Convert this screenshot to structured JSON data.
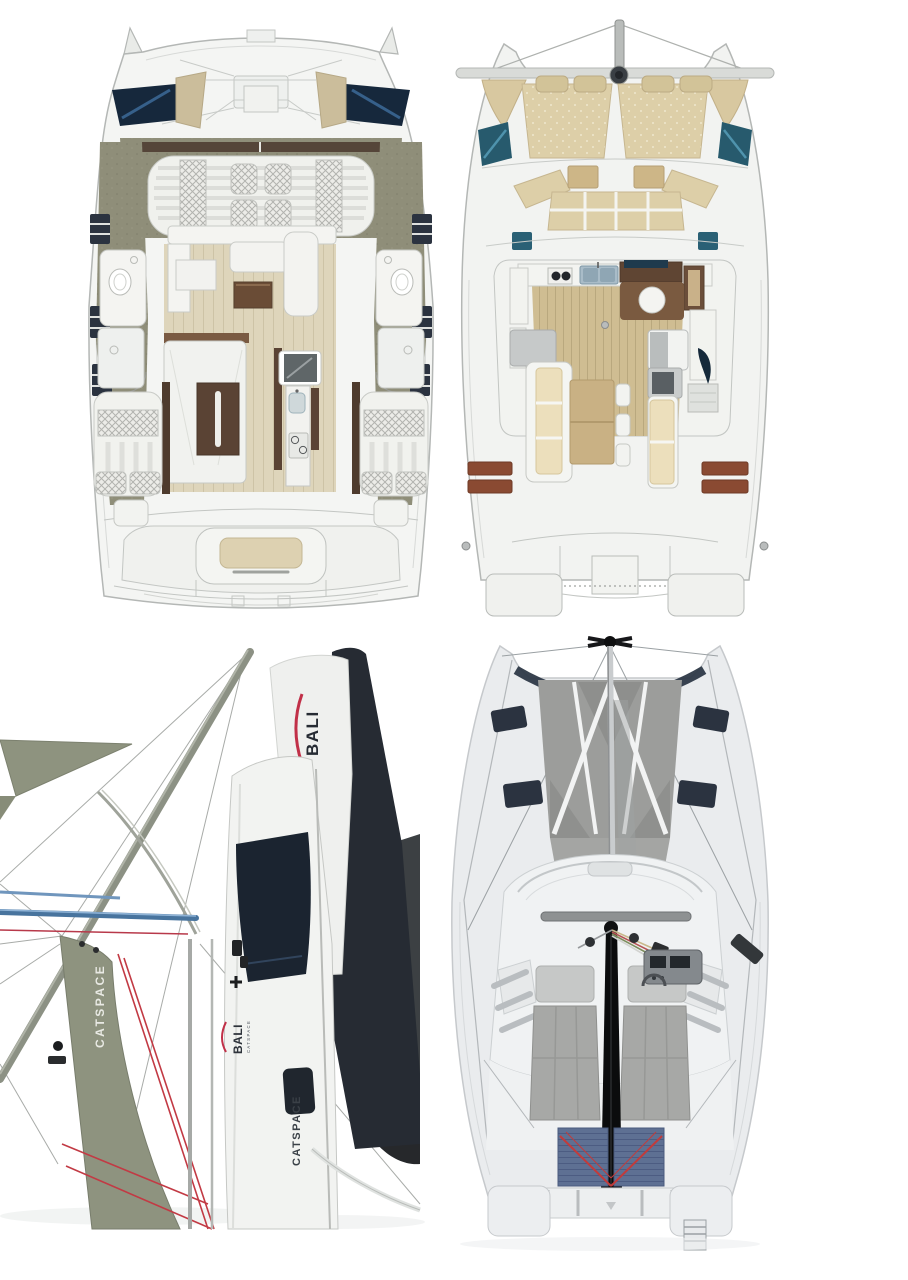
{
  "page": {
    "background": "#ffffff",
    "description": "Four views of a Bali Catspace sailing catamaran: cabin-level floor plan, main-deck floor plan, rotated sail-plan render, top-down deck render"
  },
  "branding": {
    "brand": "BALI",
    "model": "CATSPACE"
  },
  "labels": {
    "mainsail_logo": "BALI",
    "jib_label": "CATSPACE",
    "hull_logo_brand": "BALI",
    "hull_logo_model": "CATSPACE",
    "hull_side_label": "CATSPACE"
  },
  "panels": {
    "interior_plan": {
      "name": "hull-and-cabin-floorplan"
    },
    "maindeck_plan": {
      "name": "main-deck-floorplan"
    },
    "profile_render": {
      "name": "sailplan-profile-render"
    },
    "deck_render": {
      "name": "top-down-deck-render"
    }
  },
  "colors": {
    "hull_white": "#f2f3f1",
    "outline_grey": "#b4b7b5",
    "deck_olive": "#8f8e79",
    "floor_beige": "#ded5bb",
    "wood_brown": "#6a4c36",
    "window_navy": "#1c2836",
    "window_teal": "#2a5a6e",
    "cushion_beige": "#ddcfa8",
    "cushion_white": "#f0f1ed",
    "plank_wood": "#cfbd92",
    "step_rust": "#8a4a32",
    "sail_green": "#8e937f",
    "mainsail_navy": "#262b33",
    "hull_slab_grey": "#3c4043",
    "rigging_red": "#c23a44",
    "beam_blue": "#48749e",
    "tramp_grey": "#9c9d9b",
    "sunpad_grey": "#a7a8a6",
    "mesh_blue": "#5e7093",
    "boom_black": "#0b0c0d"
  }
}
